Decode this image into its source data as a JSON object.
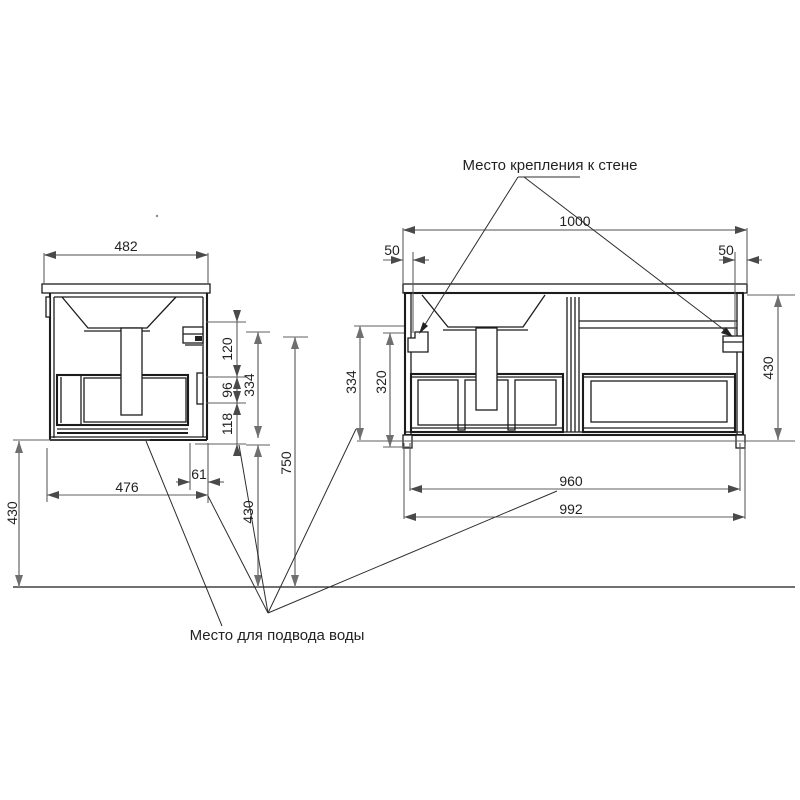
{
  "labels": {
    "wall_mount": "Место крепления к стене",
    "water_supply": "Место для подвода воды"
  },
  "side_view": {
    "top_width": "482",
    "body_width": "476",
    "rear_offset": "61",
    "bracket_drop": "120",
    "supply_zone_height": "96",
    "zone_above_bottom": "118",
    "basin_to_bottom": "334",
    "top_height": "750",
    "bottom_to_floor_left": "430",
    "bottom_to_floor_mid": "430"
  },
  "front_view": {
    "top_width": "1000",
    "left_bracket_offset": "50",
    "right_bracket_offset": "50",
    "cabinet_height": "430",
    "left_outer_height": "334",
    "left_inner_height": "320",
    "inner_width": "960",
    "outer_width": "992"
  },
  "colors": {
    "object_line": "#1c1c1c",
    "dimension_line": "#5f5f5f",
    "text": "#222222",
    "background": "#ffffff"
  }
}
